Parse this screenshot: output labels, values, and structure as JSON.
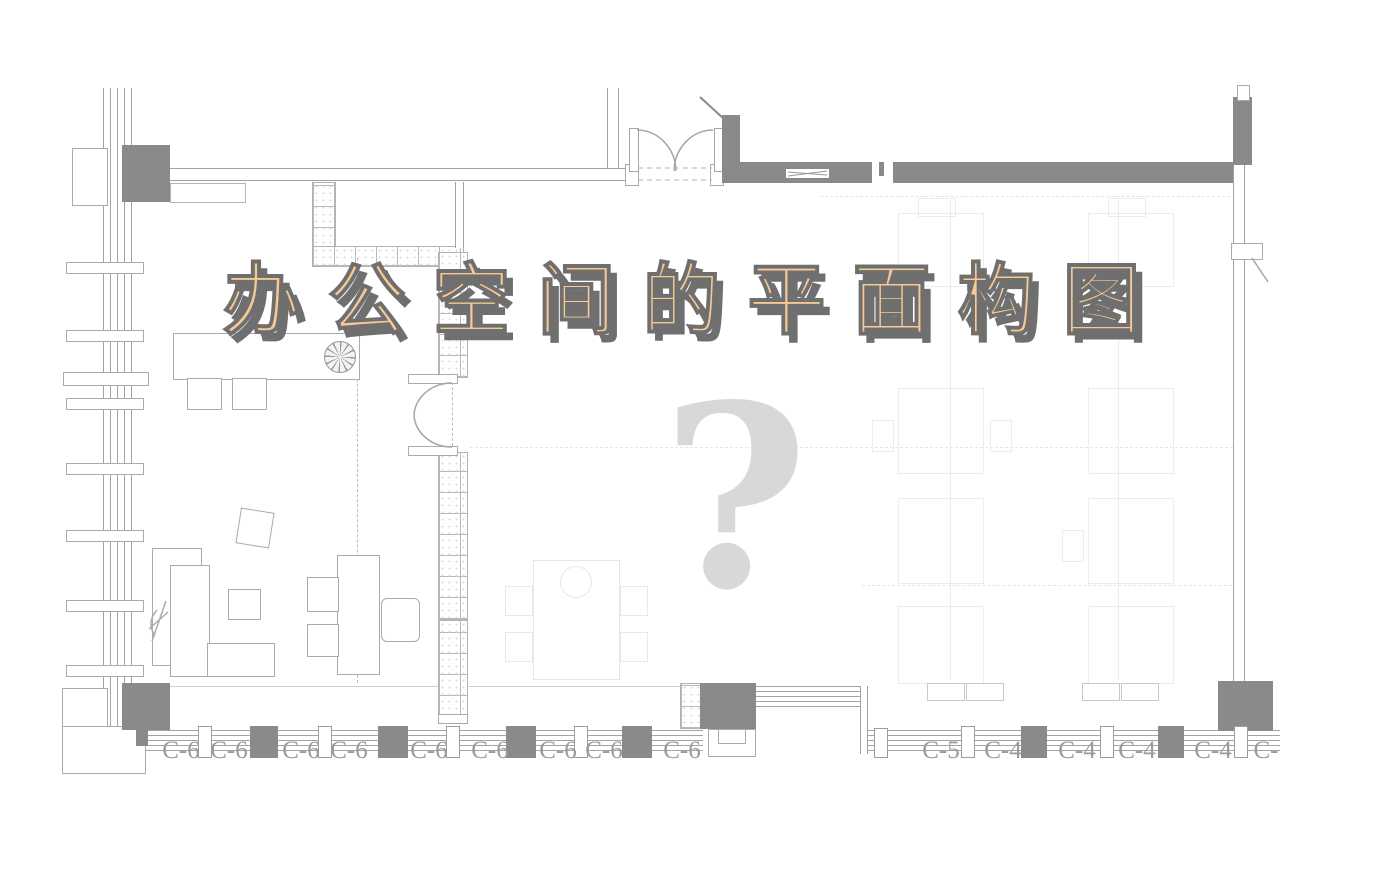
{
  "poster": {
    "title": "办公空间的平面构图",
    "watermark_question_mark": "?"
  },
  "window_labels": {
    "left": [
      "C-6",
      "C-6",
      "C-6",
      "C-6",
      "C-6",
      "C-6",
      "C-6",
      "C-6",
      "C-6"
    ],
    "right": [
      "C-5",
      "C-4",
      "C-4",
      "C-4",
      "C-4",
      "C-"
    ]
  },
  "icons": {
    "ceiling_fan": "pinwheel-circle",
    "entry_double_door": "double-swing-arcs",
    "interior_double_door": "double-swing-arcs",
    "plant": "leaf-sprig"
  },
  "colors": {
    "wall_dark": "#8a8a8a",
    "line": "#a3a3a3",
    "title_fill": "#f7c994",
    "title_shadow": "#6f6f6f",
    "qmark": "#d8d8d8",
    "label": "#9b9b9b"
  }
}
